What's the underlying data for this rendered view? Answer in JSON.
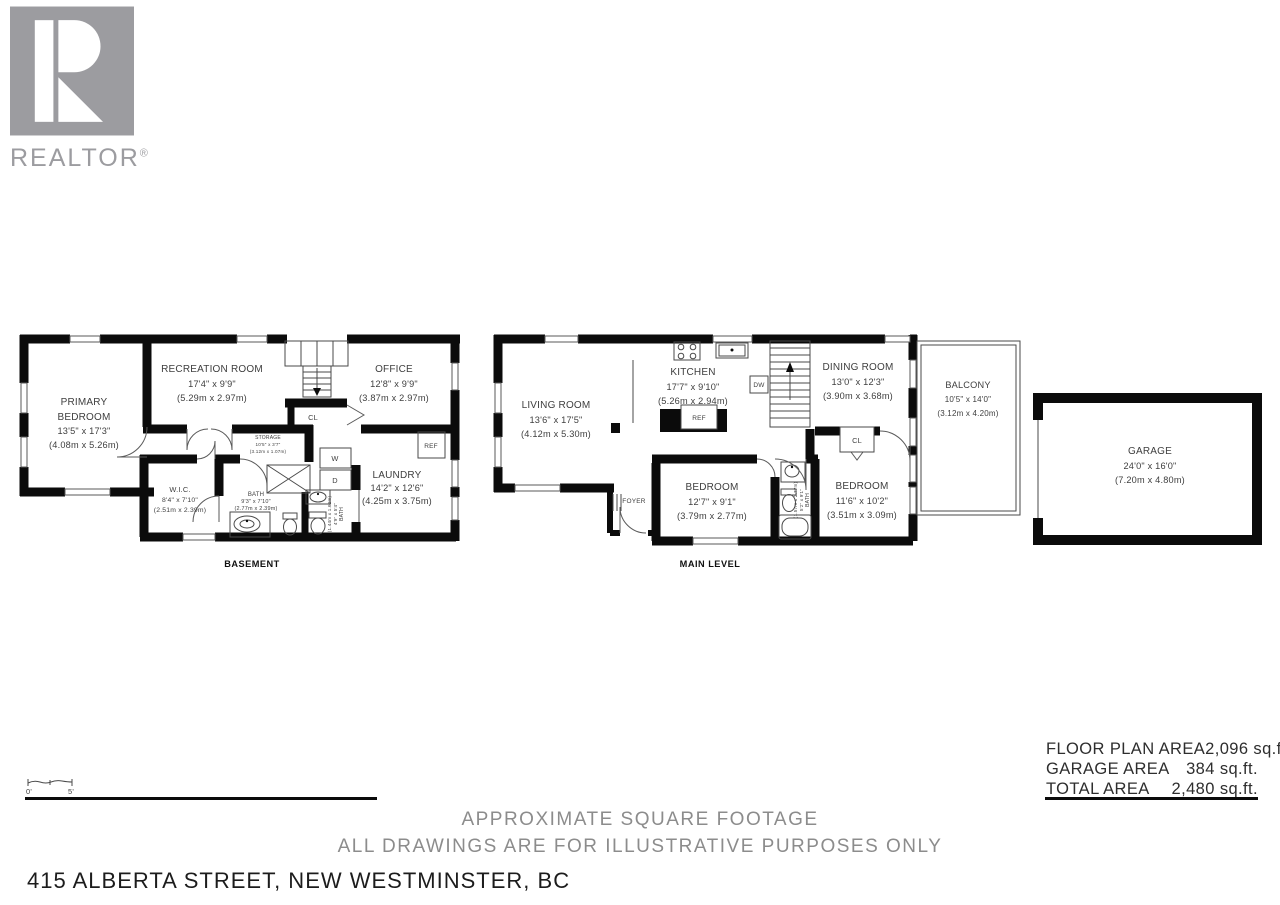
{
  "logo": {
    "brand": "REALTOR",
    "registered": "®"
  },
  "captions": {
    "basement": "BASEMENT",
    "main": "MAIN LEVEL"
  },
  "scale": {
    "zero": "0'",
    "five": "5'"
  },
  "basement": {
    "primary": {
      "name1": "PRIMARY",
      "name2": "BEDROOM",
      "imperial": "13'5\" x 17'3\"",
      "metric": "(4.08m x 5.26m)"
    },
    "recreation": {
      "name": "RECREATION ROOM",
      "imperial": "17'4\" x 9'9\"",
      "metric": "(5.29m x 2.97m)"
    },
    "office": {
      "name": "OFFICE",
      "imperial": "12'8\" x 9'9\"",
      "metric": "(3.87m x 2.97m)"
    },
    "storage": {
      "name": "STORAGE",
      "imperial": "10'5\" x 3'7\"",
      "metric": "(3.12m x 1.07m)"
    },
    "wic": {
      "name": "W.I.C.",
      "imperial": "8'4\" x 7'10\"",
      "metric": "(2.51m x 2.39m)"
    },
    "bath": {
      "name": "BATH",
      "imperial": "9'3\" x 7'10\"",
      "metric": "(2.77m x 2.39m)"
    },
    "bath_small": {
      "name": "BATH",
      "imperial": "4'9\" x 5'4\"",
      "metric": "(1.44m x 1.62m)"
    },
    "laundry": {
      "name": "LAUNDRY",
      "imperial": "14'2\" x 12'6\"",
      "metric": "(4.25m x 3.75m)"
    },
    "closet": "CL",
    "washer": "W",
    "dryer": "D",
    "fridge": "REF"
  },
  "main": {
    "living": {
      "name": "LIVING ROOM",
      "imperial": "13'6\" x 17'5\"",
      "metric": "(4.12m x 5.30m)"
    },
    "kitchen": {
      "name": "KITCHEN",
      "imperial": "17'7\" x 9'10\"",
      "metric": "(5.26m x 2.94m)"
    },
    "dining": {
      "name": "DINING ROOM",
      "imperial": "13'0\" x 12'3\"",
      "metric": "(3.90m x 3.68m)"
    },
    "balcony": {
      "name": "BALCONY",
      "imperial": "10'5\" x 14'0\"",
      "metric": "(3.12m x 4.20m)"
    },
    "bedroom1": {
      "name": "BEDROOM",
      "imperial": "12'7\" x 9'1\"",
      "metric": "(3.79m x 2.77m)"
    },
    "bedroom2": {
      "name": "BEDROOM",
      "imperial": "11'6\" x 10'2\"",
      "metric": "(3.51m x 3.09m)"
    },
    "bath": {
      "name": "BATH",
      "imperial": "5'2\" x 9'1\"",
      "metric": "(1.57m x 2.77m)"
    },
    "foyer": "FOYER",
    "closet": "CL",
    "dishwasher": "DW",
    "fridge": "REF"
  },
  "garage": {
    "name": "GARAGE",
    "imperial": "24'0\" x 16'0\"",
    "metric": "(7.20m x 4.80m)"
  },
  "areas": {
    "rows": [
      {
        "label": "FLOOR PLAN AREA",
        "value": "2,096 sq.ft."
      },
      {
        "label": "GARAGE AREA",
        "value": "384 sq.ft."
      },
      {
        "label": "TOTAL AREA",
        "value": "2,480 sq.ft."
      }
    ]
  },
  "footer": {
    "line1": "APPROXIMATE SQUARE FOOTAGE",
    "line2": "ALL DRAWINGS ARE FOR ILLUSTRATIVE PURPOSES ONLY",
    "address": "415 ALBERTA STREET, NEW WESTMINSTER, BC"
  }
}
